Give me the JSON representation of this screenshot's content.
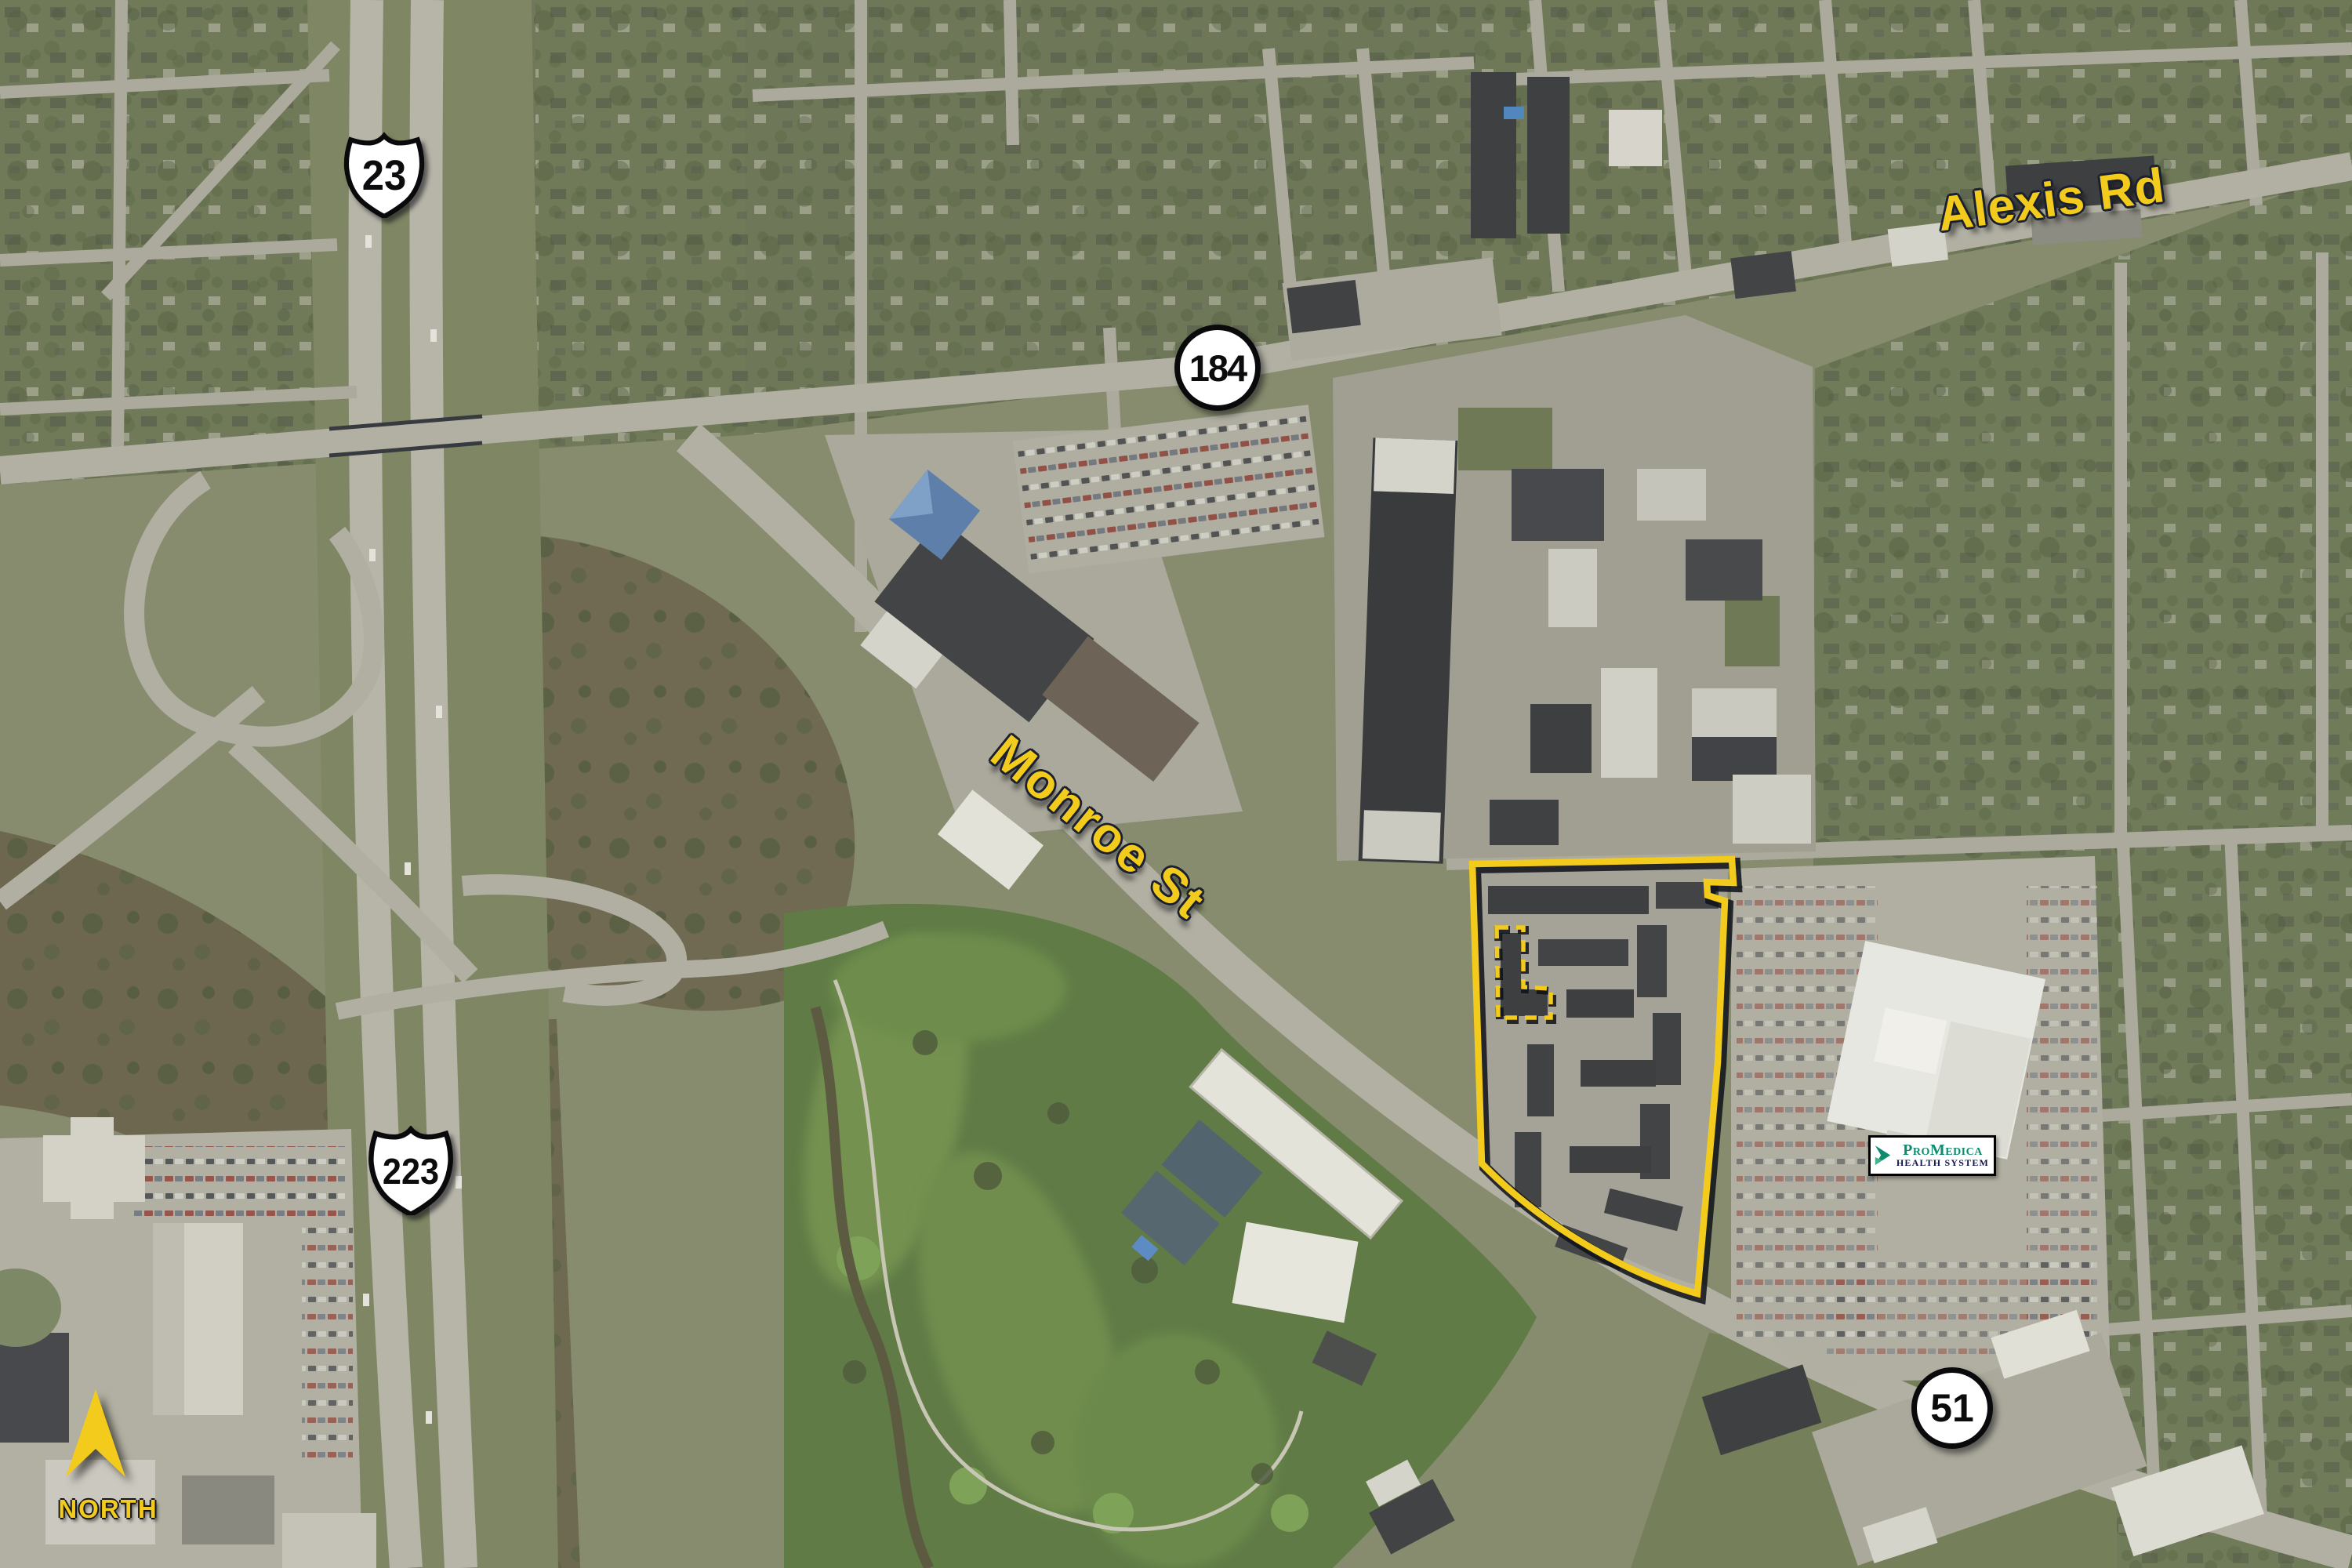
{
  "annotations": {
    "route_shields": {
      "us23": {
        "label": "23",
        "type": "us-route-shield"
      },
      "sr184": {
        "label": "184",
        "type": "circle-shield"
      },
      "us223": {
        "label": "223",
        "type": "us-route-shield"
      },
      "sr51": {
        "label": "51",
        "type": "circle-shield"
      }
    },
    "road_labels": {
      "alexis": "Alexis Rd",
      "monroe": "Monroe St"
    },
    "compass": {
      "label": "NORTH"
    },
    "promedica_sign": {
      "brand": "ProMedica",
      "subtitle": "HEALTH SYSTEM"
    },
    "colors": {
      "annotation_yellow": "#F2CB1D",
      "annotation_outline": "#161C2A",
      "shield_fill": "#FFFFFF",
      "shield_border": "#0A0A0C",
      "promedica_green": "#0E8C6D",
      "promedica_navy": "#15154A"
    }
  }
}
